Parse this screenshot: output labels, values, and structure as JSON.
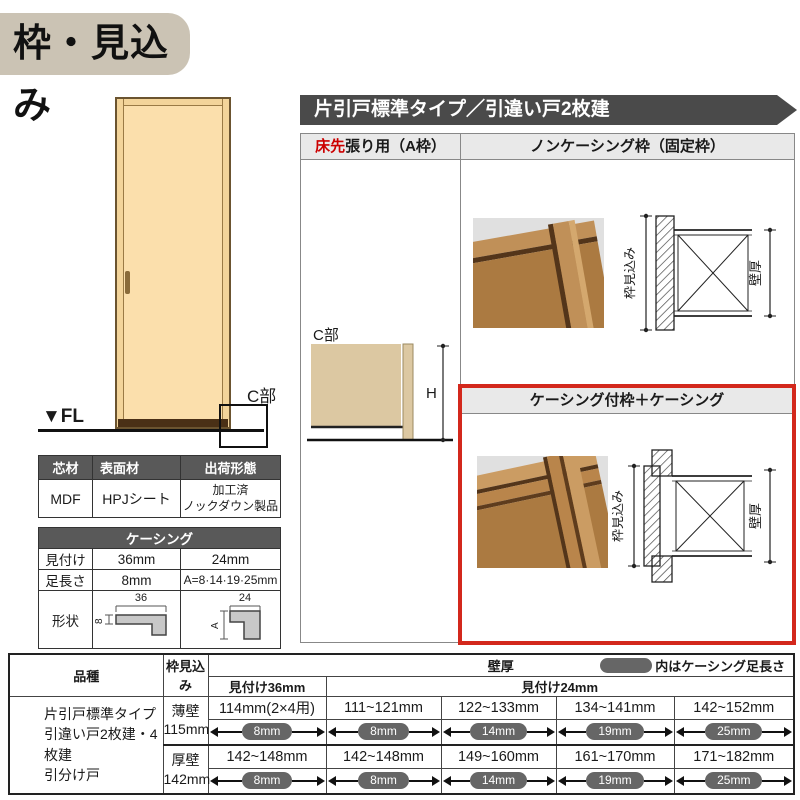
{
  "title": "枠・見込み",
  "door": {
    "fl_label": "▼FL",
    "c_label": "C部"
  },
  "material_table": {
    "headers": [
      "芯材",
      "表面材",
      "出荷形態"
    ],
    "core": "MDF",
    "surface": "HPJシート",
    "shipping_line1": "加工済",
    "shipping_line2": "ノックダウン製品"
  },
  "casing_table": {
    "title": "ケーシング",
    "row_mitsuke": {
      "label": "見付け",
      "v36": "36mm",
      "v24": "24mm"
    },
    "row_ashinagasa": {
      "label": "足長さ",
      "v36": "8mm",
      "v24": "A=8·14·19·25mm"
    },
    "row_keijou": {
      "label": "形状",
      "dim36_w": "36",
      "dim36_h": "8",
      "dim24_w": "24",
      "dim24_h": "A"
    }
  },
  "banner": "片引戸標準タイプ／引違い戸2枚建",
  "panel": {
    "a_frame": {
      "header_red": "床先",
      "header_rest": "張り用（A枠）",
      "c_label": "C部",
      "h_label": "H"
    },
    "noncasing": {
      "header": "ノンケーシング枠（固定枠）",
      "dim_depth": "枠見込み",
      "dim_wall": "壁厚"
    },
    "casing": {
      "header": "ケーシング付枠＋ケーシング",
      "dim_depth": "枠見込み",
      "dim_wall": "壁厚"
    }
  },
  "spec_table": {
    "h_hinshu": "品種",
    "h_mikomi": "枠見込み",
    "h_kabeatsu": "壁厚",
    "legend": "内はケーシング足長さ",
    "h_36": "見付け36mm",
    "h_24": "見付け24mm",
    "hinshu_line1": "片引戸標準タイプ",
    "hinshu_line2": "引違い戸2枚建・4枚建",
    "hinshu_line3": "引分け戸",
    "rows": [
      {
        "wall_label": "薄壁",
        "wall_size": "115mm",
        "cells": [
          {
            "range": "114mm(2×4用)",
            "leg": "8mm"
          },
          {
            "range": "111~121mm",
            "leg": "8mm"
          },
          {
            "range": "122~133mm",
            "leg": "14mm"
          },
          {
            "range": "134~141mm",
            "leg": "19mm"
          },
          {
            "range": "142~152mm",
            "leg": "25mm"
          }
        ]
      },
      {
        "wall_label": "厚壁",
        "wall_size": "142mm",
        "cells": [
          {
            "range": "142~148mm",
            "leg": "8mm"
          },
          {
            "range": "142~148mm",
            "leg": "8mm"
          },
          {
            "range": "149~160mm",
            "leg": "14mm"
          },
          {
            "range": "161~170mm",
            "leg": "19mm"
          },
          {
            "range": "171~182mm",
            "leg": "25mm"
          }
        ]
      }
    ]
  },
  "colors": {
    "banner_gray": "#4a4a4a",
    "header_cell_gray": "#595959",
    "pill_gray": "#666666",
    "title_beige": "#cbc3b4",
    "highlight_red": "#d3281c",
    "accent_red_text": "#cc0000",
    "door_face": "#fbdfac",
    "section_tan": "#dcc8a2",
    "subhead_gray": "#e9e9e9"
  }
}
